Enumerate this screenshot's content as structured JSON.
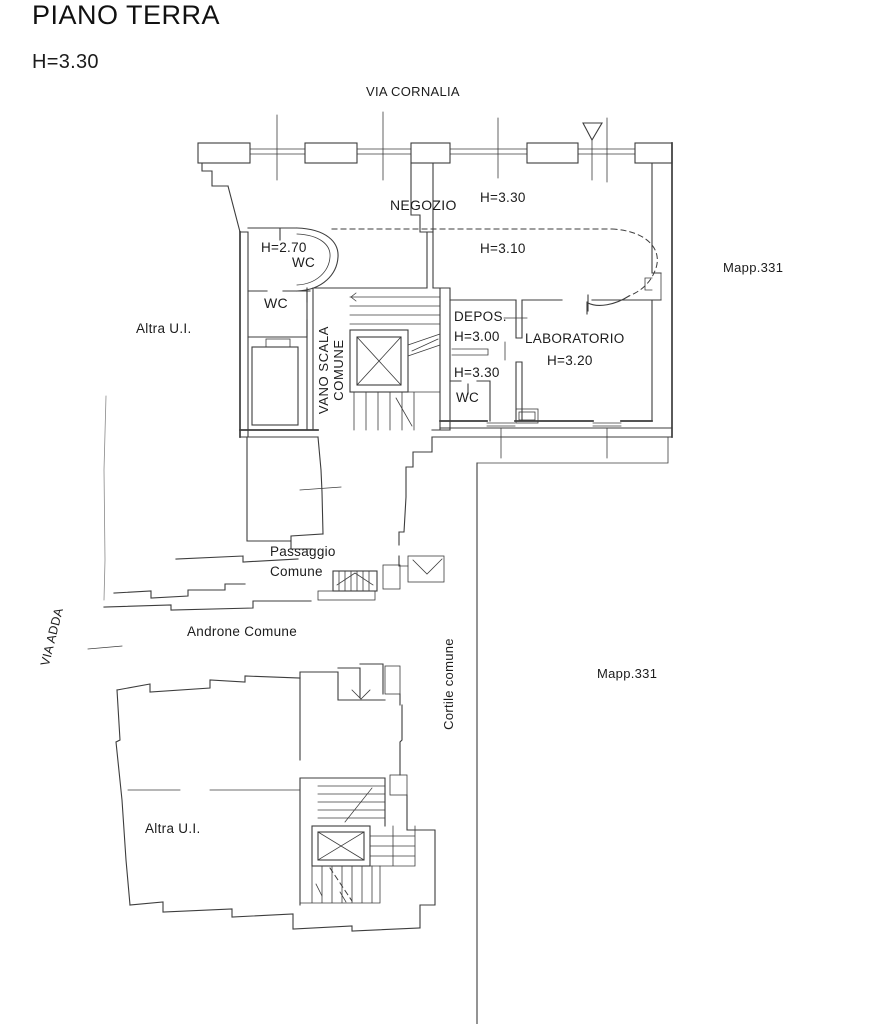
{
  "header": {
    "title": "PIANO TERRA",
    "height": "H=3.30"
  },
  "streets": {
    "top": "VIA CORNALIA",
    "left": "VIA ADDA"
  },
  "parcels": {
    "upper": "Mapp.331",
    "lower": "Mapp.331"
  },
  "common_areas": {
    "stairwell_line1": "VANO SCALA",
    "stairwell_line2": "COMUNE",
    "passage_line1": "Passaggio",
    "passage_line2": "Comune",
    "hall": "Androne Comune",
    "courtyard": "Cortile comune"
  },
  "rooms": {
    "shop": {
      "label": "NEGOZIO",
      "height_main": "H=3.30",
      "height_rear": "H=3.10"
    },
    "wc_front": {
      "height": "H=2.70",
      "label": "WC"
    },
    "wc_mid": {
      "label": "WC"
    },
    "storage": {
      "label": "DEPOS.",
      "height": "H=3.00"
    },
    "wc_rear": {
      "height": "H=3.30",
      "label": "WC"
    },
    "lab": {
      "label": "LABORATORIO",
      "height": "H=3.20"
    },
    "other_unit_upper": "Altra U.I.",
    "other_unit_lower": "Altra U.I."
  },
  "colors": {
    "line": "#3d3d3d",
    "line_faint": "#8a8a8a",
    "text": "#1c1c1c",
    "background": "#ffffff"
  }
}
